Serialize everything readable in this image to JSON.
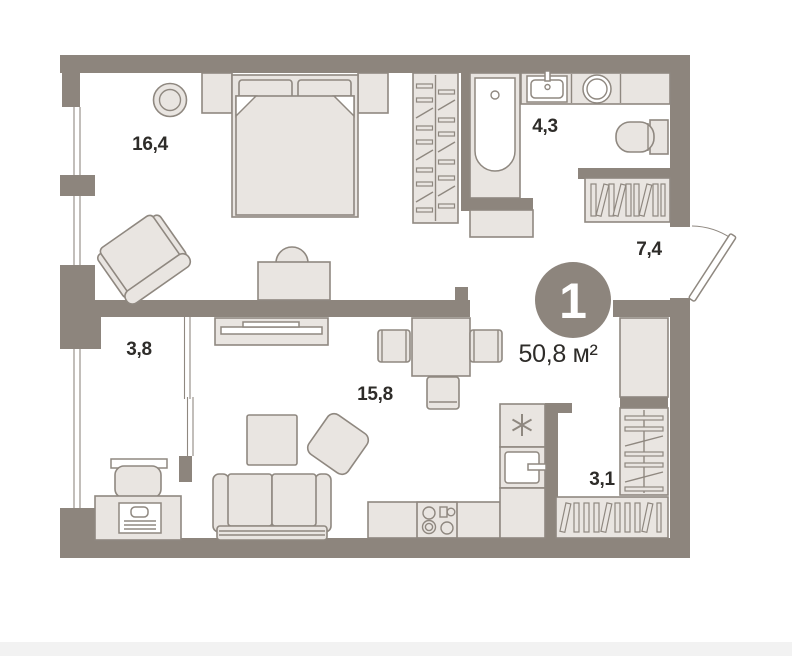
{
  "plan": {
    "badge_rooms": "1",
    "total_area": "50,8 м²",
    "room_areas": {
      "bedroom": "16,4",
      "bathroom": "4,3",
      "hallway": "7,4",
      "balcony": "3,8",
      "living_kitchen": "15,8",
      "storage": "3,1"
    },
    "colors": {
      "wall": "#8d857d",
      "furniture_fill": "#e9e5e1",
      "furniture_stroke": "#8f8880",
      "label": "#2e2c29",
      "background": "#ffffff",
      "footer_strip": "#f2f2f2",
      "badge_fill": "#8d857d",
      "badge_text": "#ffffff"
    }
  }
}
